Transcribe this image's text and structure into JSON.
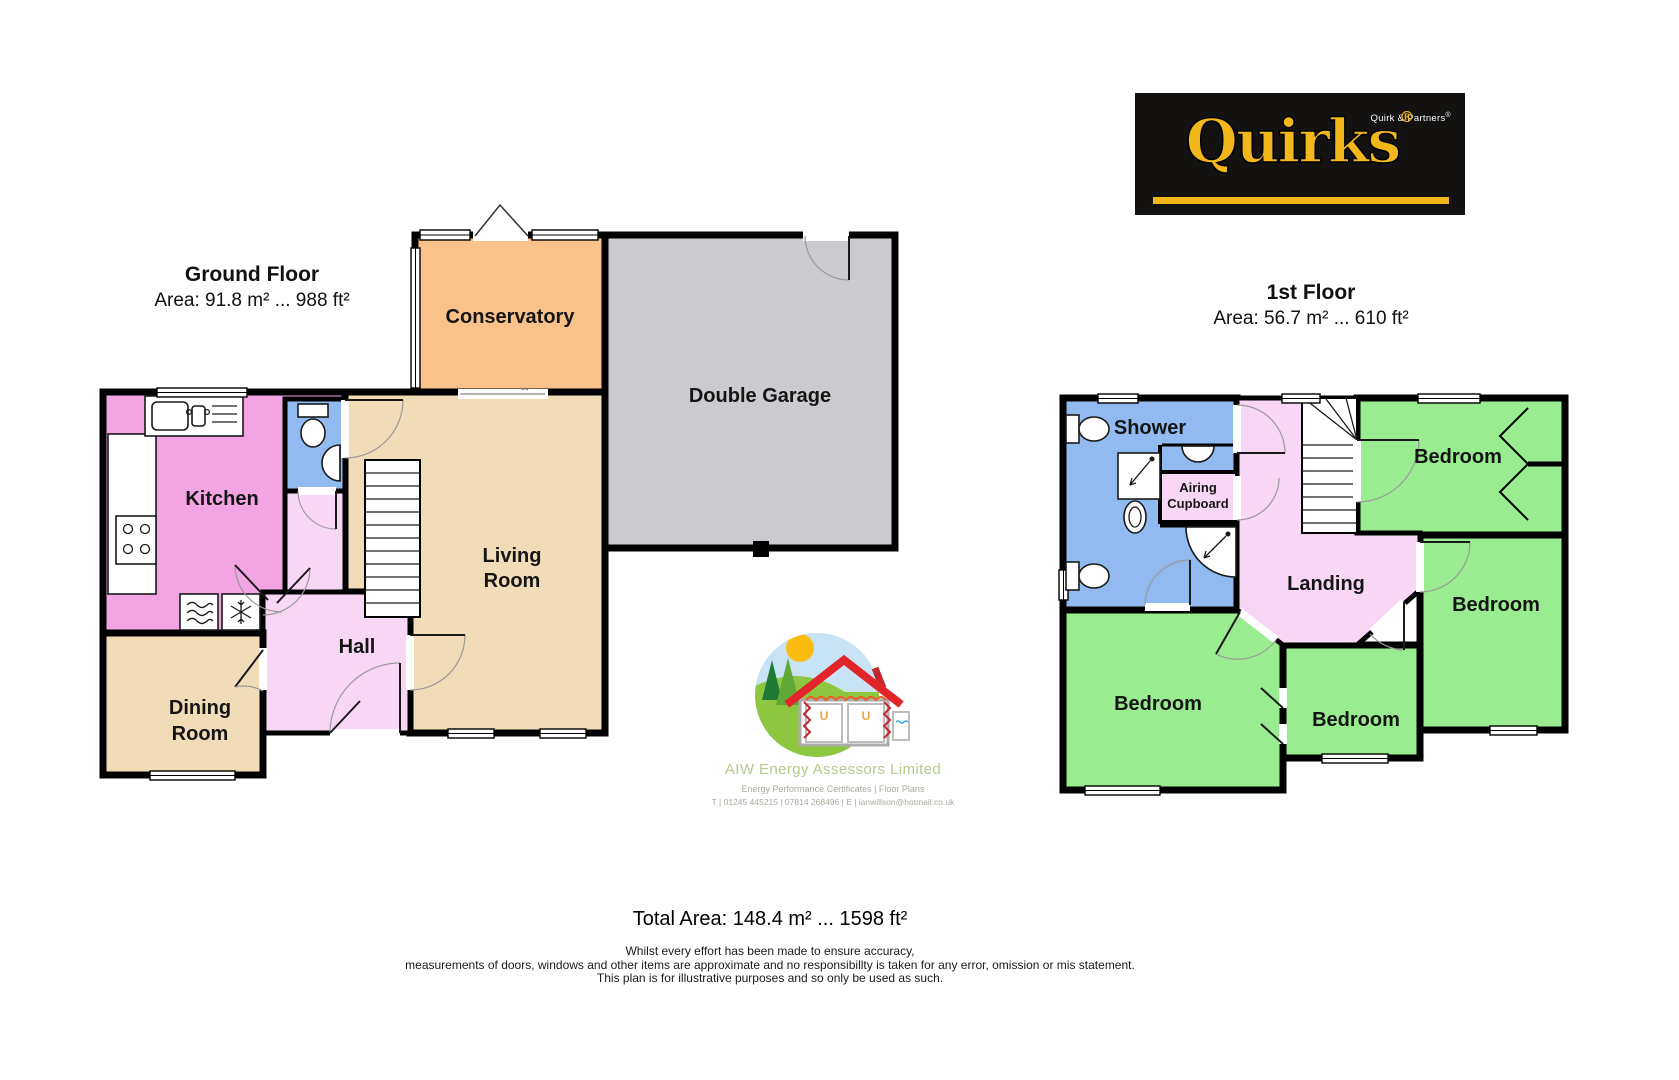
{
  "ground_floor": {
    "title": "Ground Floor",
    "area": "Area: 91.8 m² ... 988 ft²",
    "rooms": {
      "kitchen": "Kitchen",
      "conservatory": "Conservatory",
      "garage": "Double Garage",
      "living_1": "Living",
      "living_2": "Room",
      "hall": "Hall",
      "dining_1": "Dining",
      "dining_2": "Room"
    }
  },
  "first_floor": {
    "title": "1st Floor",
    "area": "Area: 56.7 m² ... 610 ft²",
    "rooms": {
      "shower": "Shower",
      "airing_1": "Airing",
      "airing_2": "Cupboard",
      "landing": "Landing",
      "bedroom_top_right": "Bedroom",
      "bedroom_right": "Bedroom",
      "bedroom_bottom_left": "Bedroom",
      "bedroom_bottom_center": "Bedroom"
    }
  },
  "branding": {
    "quirks_wordmark": "Quirks",
    "quirks_partners": "Quirk & Partners",
    "registered": "®",
    "aiw_name": "AIW Energy Assessors Limited",
    "aiw_services": "Energy Performance Certificates | Floor Plans",
    "aiw_contact": "T | 01245 445215 | 07814 268496 | E | ianwillson@hotmail.co.uk"
  },
  "summary": {
    "total_area": "Total Area: 148.4 m² ... 1598 ft²",
    "disclaimer_1": "Whilst every effort has been made to ensure accuracy,",
    "disclaimer_2": "measurements of doors, windows and other items are approximate and no responsibillty is taken for any error, omission or mis statement.",
    "disclaimer_3": "This plan is for illustrative purposes and so only be used as such."
  },
  "symbols": {
    "door_arrow": "↔"
  },
  "colors": {
    "kitchen_pink": "#F3A4E2",
    "hall_pink": "#F8D7F4",
    "tan": "#F0DDB8",
    "conservatory_orange": "#F9C28B",
    "garage_gray": "#CBCBCF",
    "bath_blue": "#90BAF0",
    "bedroom_green": "#9AEC90",
    "wall": "#000000",
    "quirks_yellow": "#F2B71B",
    "aiw_green": "#B5CA8E"
  }
}
